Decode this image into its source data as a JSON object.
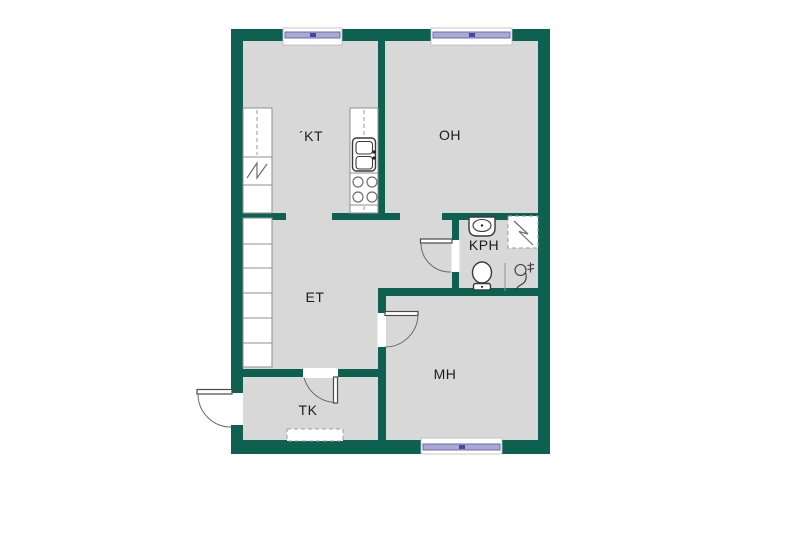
{
  "document": {
    "type": "apartment-floor-plan",
    "background": "#ffffff"
  },
  "colors": {
    "bg": "#ffffff",
    "wall": "#0e6150",
    "floor": "#d8d8d8",
    "outline": "#8f8f8f",
    "fixture": "#3a3a3a",
    "window_band": "#a9a9d6",
    "window_band_border": "#6b6bab"
  },
  "rooms": [
    {
      "key": "kt",
      "label": "´KT"
    },
    {
      "key": "oh",
      "label": "OH"
    },
    {
      "key": "et",
      "label": "ET"
    },
    {
      "key": "kph",
      "label": "KPH"
    },
    {
      "key": "mh",
      "label": "MH"
    },
    {
      "key": "tk",
      "label": "TK"
    }
  ],
  "fixtures": [
    "window",
    "window",
    "window",
    "refrigerator-symbol",
    "kitchen-sink",
    "stove-4-burners",
    "wardrobe-row",
    "washbasin",
    "shower-reservation-box",
    "toilet",
    "shower-drain-symbol",
    "door-swing-entrance",
    "door-swing-kph",
    "door-swing-mh",
    "door-swing-tk",
    "reserved-dashed-box"
  ]
}
